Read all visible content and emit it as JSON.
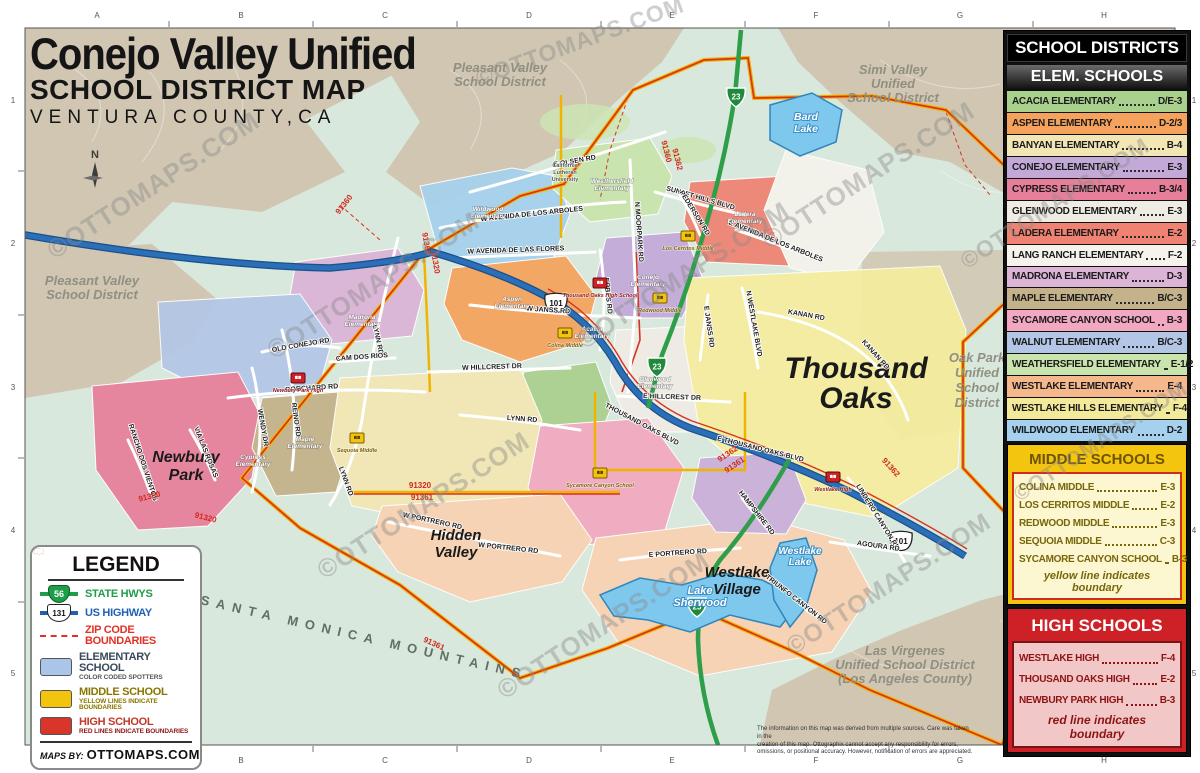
{
  "watermark": "©OTTOMAPS.COM",
  "title": {
    "line1": "Conejo Valley Unified",
    "line2": "SCHOOL DISTRICT MAP",
    "line3": "VENTURA COUNTY,CA"
  },
  "grid": {
    "cols": [
      "A",
      "B",
      "C",
      "D",
      "E",
      "F",
      "G",
      "H"
    ],
    "rows": [
      "1",
      "2",
      "3",
      "4",
      "5"
    ]
  },
  "compass": "N",
  "panel": {
    "header": "SCHOOL DISTRICTS",
    "elem": {
      "header": "ELEM. SCHOOLS",
      "rows": [
        {
          "name": "ACACIA ELEMENTARY",
          "code": "D/E-3",
          "color": "#a9d08d"
        },
        {
          "name": "ASPEN ELEMENTARY",
          "code": "D-2/3",
          "color": "#f5a35c"
        },
        {
          "name": "BANYAN ELEMENTARY",
          "code": "B-4",
          "color": "#f2e6b4"
        },
        {
          "name": "CONEJO ELEMENTARY",
          "code": "E-3",
          "color": "#c3a9d8"
        },
        {
          "name": "CYPRESS ELEMENTARY",
          "code": "B-3/4",
          "color": "#e77f9a"
        },
        {
          "name": "GLENWOOD ELEMENTARY",
          "code": "E-3",
          "color": "#efece4"
        },
        {
          "name": "LADERA ELEMENTARY",
          "code": "E-2",
          "color": "#ef8272"
        },
        {
          "name": "LANG RANCH ELEMENTARY",
          "code": "F-2",
          "color": "#f6f3ec"
        },
        {
          "name": "MADRONA ELEMENTARY",
          "code": "D-3",
          "color": "#dbb4d6"
        },
        {
          "name": "MAPLE ELEMENTARY",
          "code": "B/C-3",
          "color": "#c3b28a"
        },
        {
          "name": "SYCAMORE CANYON SCHOOL",
          "code": "B-3",
          "color": "#f2a8c0"
        },
        {
          "name": "WALNUT ELEMENTARY",
          "code": "B/C-3",
          "color": "#b3c6e6"
        },
        {
          "name": "WEATHERSFIELD ELEMENTARY",
          "code": "E-1/2",
          "color": "#c9e4ad"
        },
        {
          "name": "WESTLAKE ELEMENTARY",
          "code": "E-4",
          "color": "#f5b78c"
        },
        {
          "name": "WESTLAKE HILLS ELEMENTARY",
          "code": "F-4",
          "color": "#f2ea9a"
        },
        {
          "name": "WILDWOOD ELEMENTARY",
          "code": "D-2",
          "color": "#a5d1ee"
        }
      ]
    },
    "middle": {
      "header": "MIDDLE SCHOOLS",
      "rows": [
        {
          "name": "COLINA MIDDLE",
          "code": "E-3"
        },
        {
          "name": "LOS CERRITOS MIDDLE",
          "code": "E-2"
        },
        {
          "name": "REDWOOD MIDDLE",
          "code": "E-3"
        },
        {
          "name": "SEQUOIA MIDDLE",
          "code": "C-3"
        },
        {
          "name": "SYCAMORE CANYON SCHOOL",
          "code": "B-3"
        }
      ],
      "note": "yellow line indicates boundary"
    },
    "high": {
      "header": "HIGH SCHOOLS",
      "rows": [
        {
          "name": "WESTLAKE HIGH",
          "code": "F-4"
        },
        {
          "name": "THOUSAND OAKS HIGH",
          "code": "E-2"
        },
        {
          "name": "NEWBURY PARK HIGH",
          "code": "B-3"
        }
      ],
      "note": "red line indicates boundary"
    }
  },
  "legend": {
    "title": "LEGEND",
    "state_shield": "56",
    "state_label": "STATE HWYS",
    "us_shield": "131",
    "us_label": "US HIGHWAY",
    "zip_label": "ZIP CODE BOUNDARIES",
    "elem_label": "ELEMENTARY SCHOOL",
    "elem_sub": "COLOR CODED SPOTTERS",
    "middle_label": "MIDDLE SCHOOL",
    "middle_sub": "YELLOW LINES INDICATE BOUNDARIES",
    "high_label": "HIGH SCHOOL",
    "high_sub": "RED LINES INDICATE BOUNDARIES",
    "maps_by": "MAPS BY:",
    "brand": "OTTOMAPS.COM",
    "colors": {
      "state": "#1e9e48",
      "us": "#1f63b0",
      "zip": "#e03325",
      "elem": "#a9c6e8",
      "middle": "#f2c40d",
      "high": "#d8352b",
      "state_text": "#1e9e48",
      "us_text": "#1f63b0",
      "zip_text": "#e03325",
      "elem_text": "#3a4a5a",
      "middle_text": "#8a7500",
      "high_text": "#c0392b"
    }
  },
  "map": {
    "districts": [
      {
        "lines": [
          "Pleasant Valley",
          "School District"
        ]
      },
      {
        "lines": [
          "Simi Valley",
          "Unified",
          "School District"
        ]
      },
      {
        "lines": [
          "Pleasant Valley",
          "School District"
        ]
      },
      {
        "lines": [
          "Oak Park",
          "Unified",
          "School",
          "District"
        ]
      },
      {
        "lines": [
          "Las Virgenes",
          "Unified School District",
          "(Los Angeles County)"
        ]
      }
    ],
    "cities": [
      {
        "lines": [
          "Thousand",
          "Oaks"
        ]
      },
      {
        "lines": [
          "Newbury",
          "Park"
        ]
      },
      {
        "lines": [
          "Hidden",
          "Valley"
        ]
      },
      {
        "lines": [
          "Westlake",
          "Village"
        ]
      }
    ],
    "mountains": "SANTA MONICA MOUNTAINS",
    "lakes": [
      {
        "lines": [
          "Bard",
          "Lake"
        ]
      },
      {
        "lines": [
          "Lake",
          "Sherwood"
        ]
      },
      {
        "lines": [
          "Westlake",
          "Lake"
        ]
      }
    ],
    "roads": [
      "E OLSEN RD",
      "W AVENIDA DE LOS ARBOLES",
      "E AVENIDA DE LOS ARBOLES",
      "W AVENIDA DE LAS FLORES",
      "W JANSS RD",
      "E JANSS RD",
      "N MOORPARK RD",
      "LYNN RD",
      "REINO RD",
      "WENDY DR",
      "BORCHARD RD",
      "W HILLCREST DR",
      "E HILLCREST DR",
      "THOUSAND OAKS BLVD",
      "E THOUSAND OAKS BLVD",
      "KANAN RD",
      "LINDERO CANYON RD",
      "N WESTLAKE BLVD",
      "W PORTRERO RD",
      "E PORTRERO RD",
      "AGOURA RD",
      "SUNSET HILLS BLVD",
      "ERBES RD",
      "OLD CONEJO RD",
      "HAMPSHIRE RD",
      "TRIUNFO CANYON RD",
      "PEDERSON RD",
      "CAM DOS RIOS",
      "VIA LAS ROSAS",
      "RANCHO DOS VIENTOS"
    ],
    "zips": [
      "91360",
      "91320",
      "91361",
      "91362"
    ],
    "shields": {
      "us": "101",
      "state": "23"
    },
    "schools": {
      "high": [
        "Newbury Park High",
        "Thousand Oaks High School",
        "Westlake High"
      ],
      "middle": [
        "Sequoia Middle",
        "Colina Middle",
        "Redwood Middle",
        "Los Cerritos Middle",
        "Sycamore Canyon School"
      ],
      "elem": [
        {
          "lines": [
            "Wildwood",
            "Elementary"
          ]
        },
        {
          "lines": [
            "Weathersfield",
            "Elementary"
          ]
        },
        {
          "lines": [
            "Ladera",
            "Elementary"
          ]
        },
        {
          "lines": [
            "Aspen",
            "Elementary"
          ]
        },
        {
          "lines": [
            "Acacia",
            "Elementary"
          ]
        },
        {
          "lines": [
            "Conejo",
            "Elementary"
          ]
        },
        {
          "lines": [
            "Glenwood",
            "Elementary"
          ]
        },
        {
          "lines": [
            "Madrona",
            "Elementary"
          ]
        },
        {
          "lines": [
            "Maple",
            "Elementary"
          ]
        },
        {
          "lines": [
            "Cypress",
            "Elementary"
          ]
        }
      ],
      "university": {
        "lines": [
          "California",
          "Lutheran",
          "University"
        ]
      }
    }
  },
  "fine_print": {
    "lines": [
      "The information on this map was derived from multiple sources. Care was taken in the",
      "creation of this map. Ottographix cannot accept any responsibility for errors,",
      "omissions, or positional accuracy. However, notification of errors are appreciated."
    ]
  }
}
